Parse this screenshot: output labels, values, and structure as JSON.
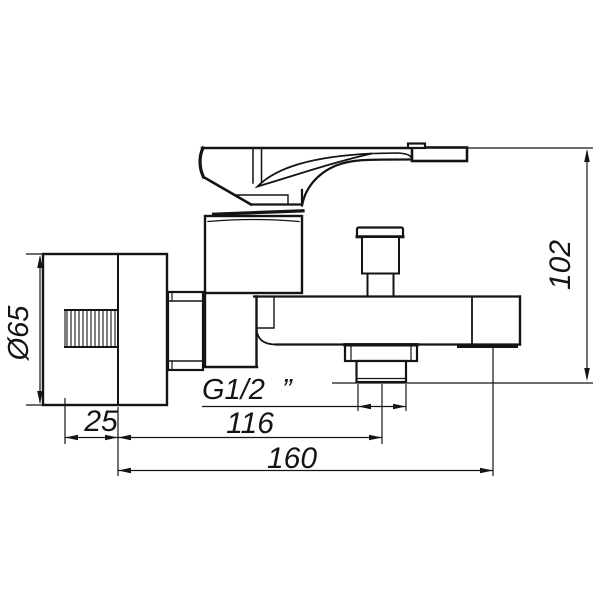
{
  "drawing": {
    "subject": "Wall-mounted single-lever bath mixer tap, side elevation technical drawing",
    "background": "#ffffff",
    "line_color": "#141414",
    "dimensions": [
      {
        "id": "flange-diameter",
        "label": "Ø65",
        "axis": "vertical"
      },
      {
        "id": "wall-thread-length",
        "label": "25",
        "axis": "horizontal"
      },
      {
        "id": "shower-outlet-offset",
        "label": "116",
        "axis": "horizontal"
      },
      {
        "id": "overall-length",
        "label": "160",
        "axis": "horizontal"
      },
      {
        "id": "overall-height",
        "label": "102",
        "axis": "vertical"
      },
      {
        "id": "connection-thread",
        "label": "G1/2",
        "suffix": "”",
        "axis": "leader"
      }
    ]
  }
}
